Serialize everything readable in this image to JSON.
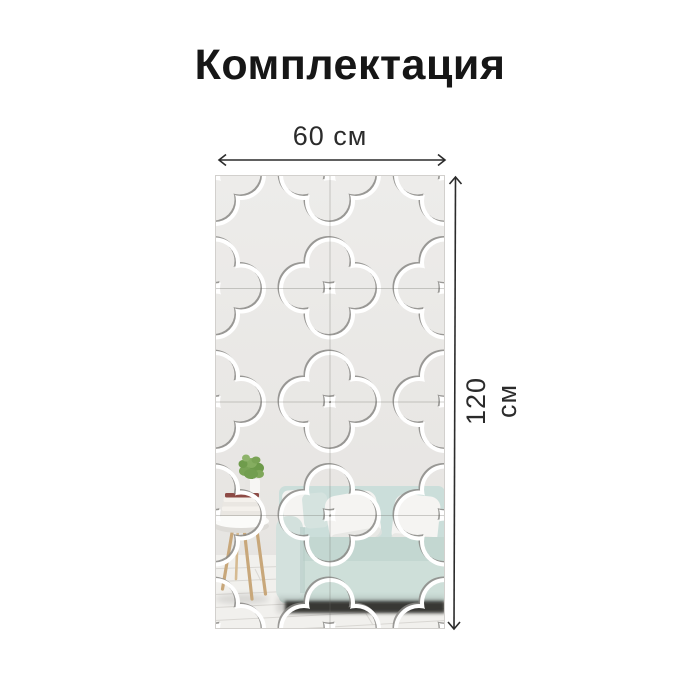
{
  "title": "Комплектация",
  "diagram": {
    "width_label": "60 см",
    "height_label": "120 см",
    "panel": {
      "columns": 2,
      "rows": 4,
      "tiles_total": 8,
      "pattern": "quatrefoil-mirror-tiles"
    }
  },
  "scene": {
    "description_items": [
      "sofa",
      "white-pillows",
      "wooden-stool",
      "books",
      "plant",
      "plank-floor"
    ]
  },
  "colors": {
    "text": "#161616",
    "arrow": "#2b2b2b",
    "groove": "#ffffff",
    "groove_shadow": "#8b8a87",
    "seam": "#6e6c68",
    "wall_top": "#edecea",
    "wall_bottom": "#e5e3e0",
    "sofa": "#cbdeda",
    "sofa_seat": "#c3d7d1",
    "sofa_front": "#cedfd9",
    "sofa_arm": "#d3e1dd",
    "pillow": "#f5f4f2",
    "pillow_accent": "#d5e3df",
    "wood": "#c8a77a",
    "wood_light": "#d6bb92",
    "table_top": "#fbfbf9",
    "table_rim": "#dddbd7",
    "book": "#8d4a45",
    "pot": "#f7f6f4",
    "plant": "#74a050",
    "floor": "#f1f0ed",
    "floor_line": "#d9d7d3",
    "under_sofa_shadow": "#33322d"
  }
}
